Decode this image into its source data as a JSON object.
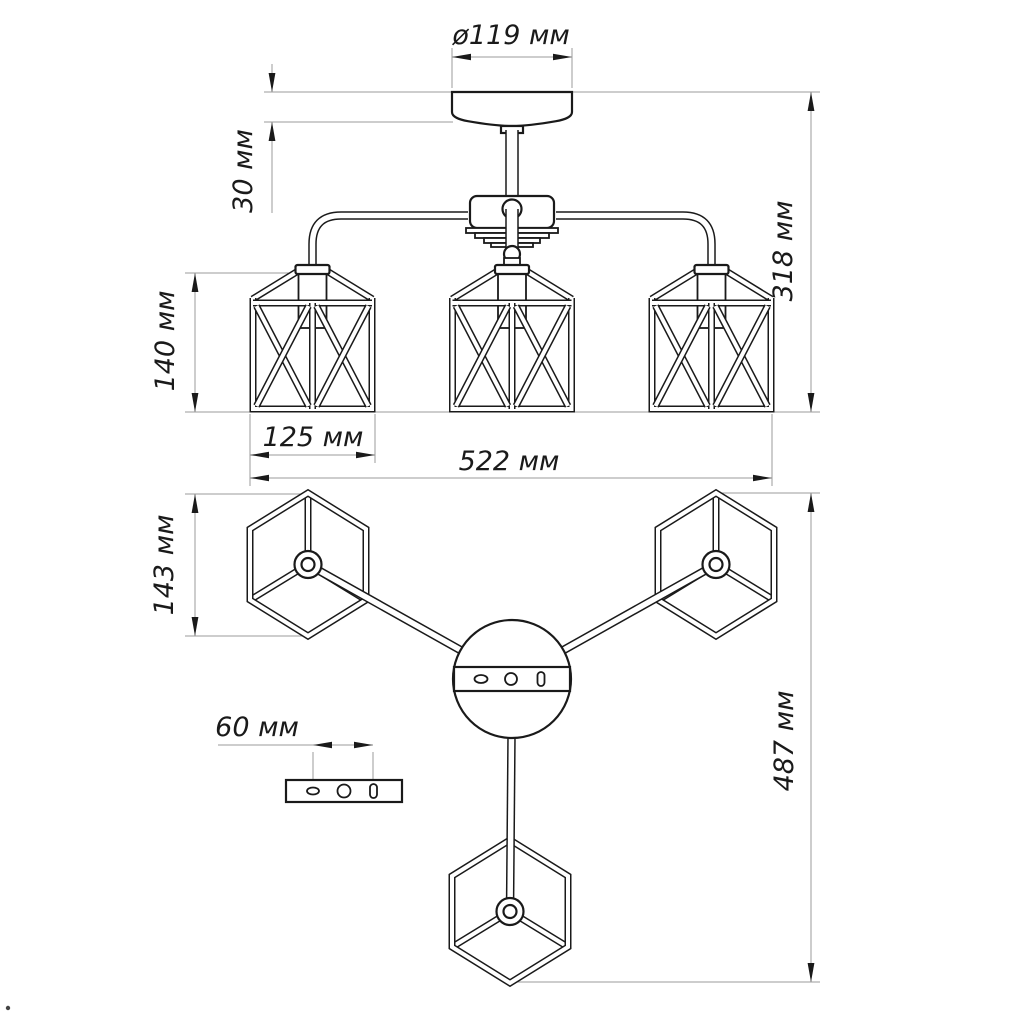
{
  "drawing": {
    "dimensions": {
      "canopy_diameter": "ø119 мм",
      "canopy_offset": "30 мм",
      "fixture_height": "318 мм",
      "shade_height_front": "140 мм",
      "shade_width": "125 мм",
      "fixture_width": "522 мм",
      "shade_height_plan": "143 мм",
      "fixture_span_plan": "487 мм",
      "mount_hole_spacing": "60 мм"
    },
    "colors": {
      "object_line": "#1a1a1a",
      "dimension_line": "#9b9b9b",
      "background": "#ffffff"
    }
  }
}
